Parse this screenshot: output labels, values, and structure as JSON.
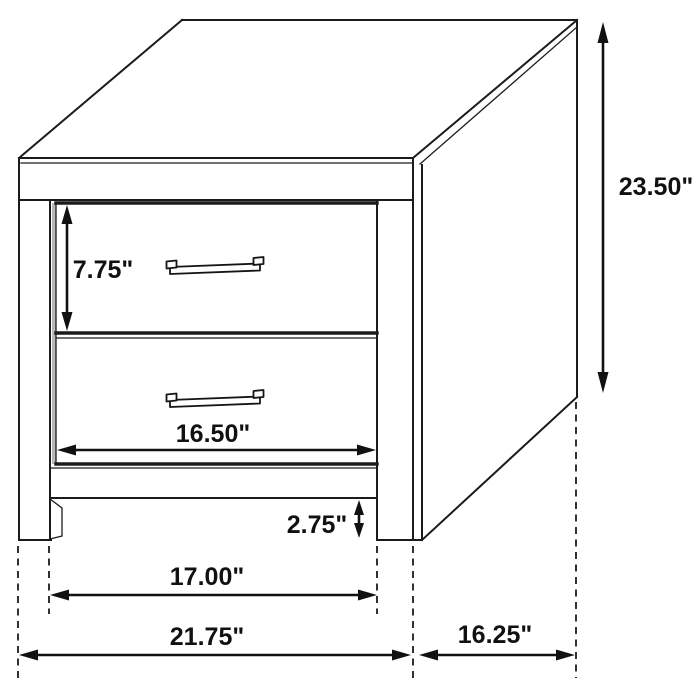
{
  "figure": {
    "kind": "furniture-dimension-diagram",
    "subject": "two-drawer nightstand",
    "background_color": "#ffffff",
    "line_color": "#1b1b1b"
  },
  "dimensions": {
    "overall_height": "23.50\"",
    "drawer_front_height": "7.75\"",
    "drawer_width": "16.50\"",
    "base_clearance": "2.75\"",
    "inner_leg_width": "17.00\"",
    "overall_width": "21.75\"",
    "overall_depth": "16.25\""
  }
}
